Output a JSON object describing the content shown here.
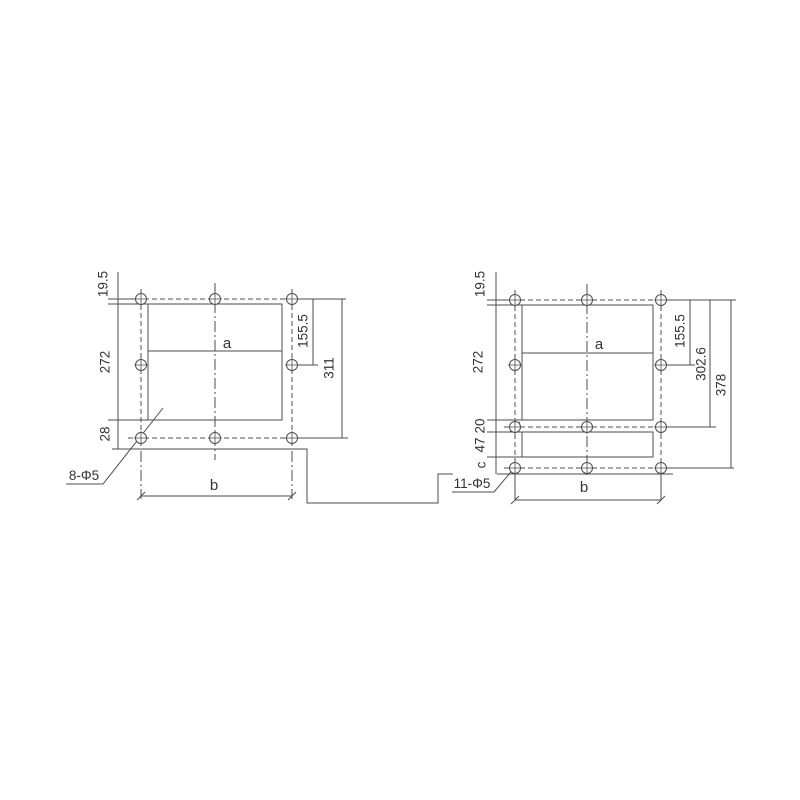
{
  "drawing": {
    "background": "#ffffff",
    "line_color": "#4d4d4d",
    "text_color": "#333333",
    "left_view": {
      "hole_spec": "8-Φ5",
      "cutout_label": "a",
      "width_label": "b",
      "dim_top_offset": "19.5",
      "dim_height": "272",
      "dim_bottom_offset": "28",
      "dim_inner_height": "155.5",
      "dim_outer_height": "311"
    },
    "right_view": {
      "hole_spec": "11-Φ5",
      "cutout_label": "a",
      "width_label": "b",
      "dim_top_offset": "19.5",
      "dim_height": "272",
      "dim_gap": "20",
      "dim_small_height": "47",
      "dim_bottom_margin": "c",
      "dim_inner_height": "155.5",
      "dim_mid_height": "302.6",
      "dim_outer_height": "378"
    }
  }
}
